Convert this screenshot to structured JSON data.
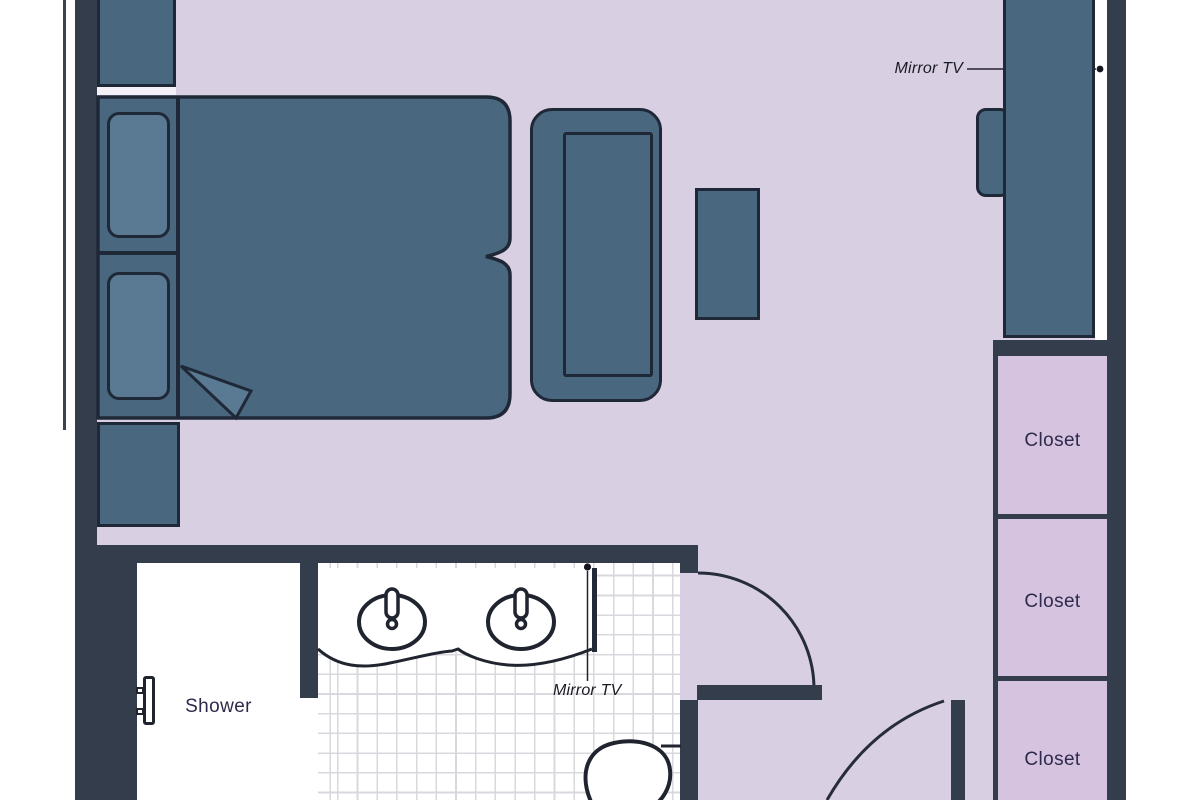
{
  "plan": {
    "title": "hotel-room-floor-plan",
    "rooms": {
      "shower_label": "Shower"
    },
    "closets": [
      "Closet",
      "Closet",
      "Closet"
    ],
    "annotations": {
      "mirror_tv_top": "Mirror TV",
      "mirror_tv_bottom": "Mirror TV"
    },
    "fixtures": [
      "double-bed",
      "nightstand",
      "nightstand",
      "sofa",
      "coffee-table",
      "wardrobe-mirror-tv-unit",
      "vanity-two-sinks",
      "toilet",
      "shower",
      "entry-door",
      "bathroom-door"
    ],
    "colors": {
      "wall": "#333d4c",
      "wall_line": "#232a37",
      "furniture": "#4a6780",
      "furniture_outline": "#1f2837",
      "pillow": "#5a7992",
      "floor": "#d8cfe2",
      "closet": "#d6c3e0",
      "bath": "#ffffff",
      "tile": "#d8d8de",
      "text": "#2e2a4c",
      "label": "#1a1a24"
    }
  }
}
